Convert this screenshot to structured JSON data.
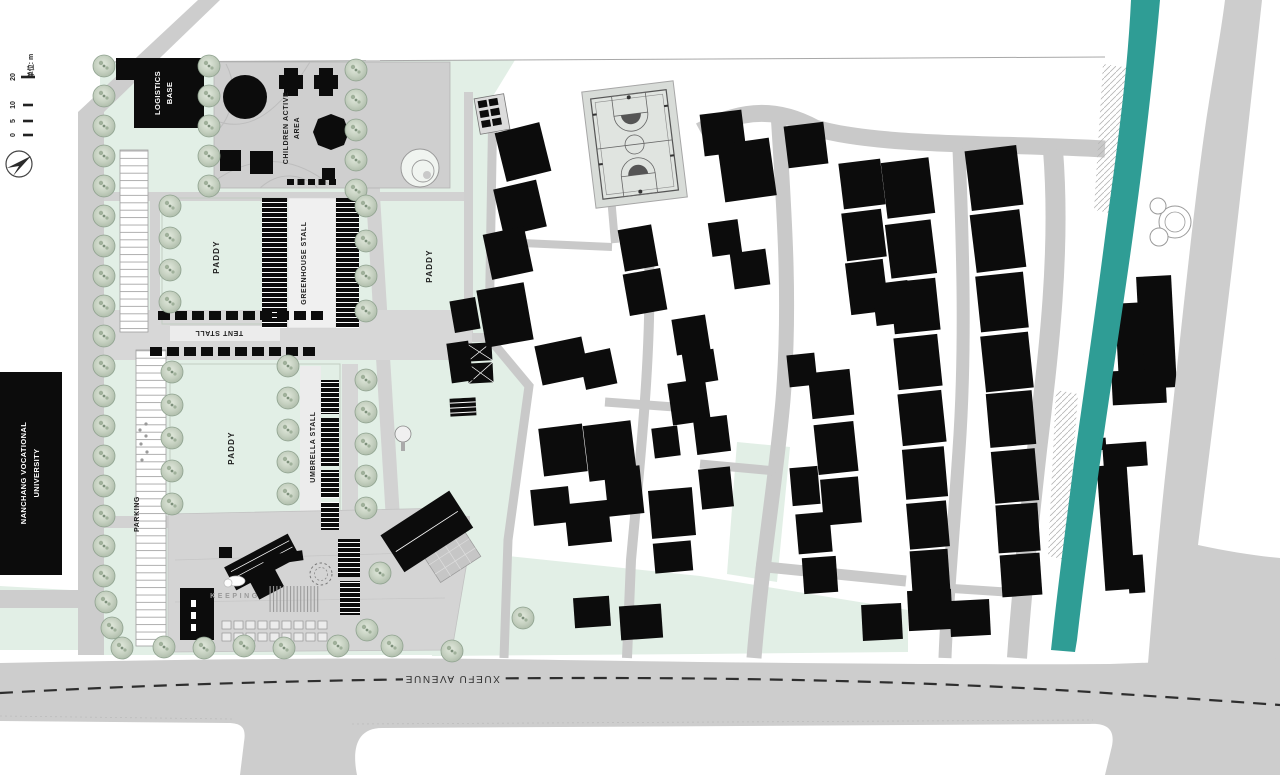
{
  "labels": {
    "logistics": {
      "l1": "LOGISTICS",
      "l2": "BASE"
    },
    "children": {
      "l1": "CHILDREN ACTIVE",
      "l2": "AREA"
    },
    "paddy1": "PADDY",
    "paddy2": "PADDY",
    "paddy3": "PADDY",
    "greenhouse": "GREENHOUSE STALL",
    "tent": "TENT STALL",
    "umbrella": "UMBRELLA STALL",
    "parking": "PARKING",
    "university": {
      "l1": "NANCHANG VOCATIONAL",
      "l2": "UNIVERSITY"
    },
    "keeping": "KEEPING",
    "avenue": "XUEFU AVENUE"
  },
  "scale_bar": {
    "ticks": [
      "0",
      "5",
      "10",
      "20"
    ],
    "unit": "单位: m"
  },
  "colors": {
    "mint": "#e2efe6",
    "road": "#cdcdcd",
    "road_dark": "#c9c9c9",
    "plaza": "#d2d2d2",
    "building": "#0c0c0c",
    "river": "#2f9d95",
    "tree_fill": "#c9d3c5",
    "tree_stroke": "#8fa28f",
    "court_bg": "#e0e4e0"
  },
  "plan": {
    "trees": [
      [
        104,
        66
      ],
      [
        104,
        96
      ],
      [
        104,
        126
      ],
      [
        104,
        156
      ],
      [
        104,
        186
      ],
      [
        104,
        216
      ],
      [
        104,
        246
      ],
      [
        104,
        276
      ],
      [
        104,
        306
      ],
      [
        104,
        336
      ],
      [
        104,
        366
      ],
      [
        104,
        396
      ],
      [
        104,
        426
      ],
      [
        104,
        456
      ],
      [
        104,
        486
      ],
      [
        104,
        516
      ],
      [
        104,
        546
      ],
      [
        104,
        576
      ],
      [
        106,
        602
      ],
      [
        112,
        628
      ],
      [
        209,
        66
      ],
      [
        209,
        96
      ],
      [
        209,
        126
      ],
      [
        209,
        156
      ],
      [
        209,
        186
      ],
      [
        356,
        70
      ],
      [
        356,
        100
      ],
      [
        356,
        130
      ],
      [
        356,
        160
      ],
      [
        356,
        190
      ],
      [
        170,
        206
      ],
      [
        170,
        238
      ],
      [
        170,
        270
      ],
      [
        170,
        302
      ],
      [
        366,
        206
      ],
      [
        366,
        241
      ],
      [
        366,
        276
      ],
      [
        366,
        311
      ],
      [
        172,
        372
      ],
      [
        172,
        405
      ],
      [
        172,
        438
      ],
      [
        172,
        471
      ],
      [
        172,
        504
      ],
      [
        288,
        366
      ],
      [
        288,
        398
      ],
      [
        288,
        430
      ],
      [
        288,
        462
      ],
      [
        288,
        494
      ],
      [
        366,
        380
      ],
      [
        366,
        412
      ],
      [
        366,
        444
      ],
      [
        366,
        476
      ],
      [
        366,
        508
      ],
      [
        122,
        648
      ],
      [
        164,
        647
      ],
      [
        204,
        648
      ],
      [
        244,
        646
      ],
      [
        284,
        648
      ],
      [
        338,
        646
      ],
      [
        392,
        646
      ],
      [
        452,
        651
      ],
      [
        380,
        573
      ],
      [
        367,
        630
      ],
      [
        523,
        618
      ]
    ],
    "village_buildings": [
      [
        500,
        127,
        46,
        50,
        -14
      ],
      [
        498,
        184,
        44,
        48,
        -13
      ],
      [
        487,
        230,
        42,
        46,
        -12
      ],
      [
        481,
        286,
        48,
        58,
        -10
      ],
      [
        452,
        299,
        26,
        32,
        -10
      ],
      [
        449,
        342,
        22,
        40,
        -8
      ],
      [
        538,
        341,
        48,
        40,
        -12
      ],
      [
        582,
        351,
        32,
        36,
        -12
      ],
      [
        541,
        426,
        44,
        48,
        -7
      ],
      [
        586,
        423,
        48,
        56,
        -7
      ],
      [
        532,
        488,
        38,
        36,
        -6
      ],
      [
        566,
        502,
        44,
        42,
        -6
      ],
      [
        606,
        467,
        36,
        48,
        -6
      ],
      [
        650,
        489,
        44,
        48,
        -5
      ],
      [
        654,
        542,
        38,
        30,
        -5
      ],
      [
        574,
        597,
        36,
        30,
        -4
      ],
      [
        620,
        605,
        42,
        34,
        -4
      ],
      [
        621,
        227,
        34,
        42,
        -10
      ],
      [
        626,
        271,
        38,
        42,
        -10
      ],
      [
        674,
        317,
        34,
        36,
        -9
      ],
      [
        684,
        351,
        32,
        32,
        -9
      ],
      [
        670,
        381,
        38,
        42,
        -8
      ],
      [
        695,
        417,
        34,
        36,
        -7
      ],
      [
        653,
        427,
        26,
        30,
        -7
      ],
      [
        702,
        112,
        42,
        42,
        -7
      ],
      [
        721,
        141,
        52,
        58,
        -8
      ],
      [
        710,
        221,
        30,
        34,
        -8
      ],
      [
        732,
        251,
        36,
        36,
        -8
      ],
      [
        700,
        468,
        32,
        40,
        -6
      ],
      [
        786,
        124,
        40,
        42,
        -7
      ],
      [
        841,
        161,
        42,
        46,
        -7
      ],
      [
        844,
        211,
        40,
        48,
        -7
      ],
      [
        848,
        261,
        38,
        52,
        -7
      ],
      [
        788,
        354,
        28,
        32,
        -6
      ],
      [
        810,
        371,
        42,
        46,
        -6
      ],
      [
        816,
        423,
        40,
        50,
        -6
      ],
      [
        822,
        478,
        38,
        46,
        -5
      ],
      [
        791,
        467,
        28,
        38,
        -5
      ],
      [
        797,
        513,
        34,
        40,
        -5
      ],
      [
        803,
        557,
        34,
        36,
        -4
      ],
      [
        874,
        282,
        36,
        42,
        -7
      ],
      [
        884,
        160,
        48,
        56,
        -7
      ],
      [
        888,
        222,
        46,
        54,
        -7
      ],
      [
        892,
        280,
        46,
        52,
        -6
      ],
      [
        896,
        336,
        44,
        52,
        -6
      ],
      [
        900,
        392,
        44,
        52,
        -6
      ],
      [
        904,
        448,
        42,
        50,
        -5
      ],
      [
        908,
        502,
        40,
        46,
        -5
      ],
      [
        911,
        550,
        38,
        42,
        -4
      ],
      [
        862,
        604,
        40,
        36,
        -3
      ],
      [
        908,
        590,
        44,
        40,
        -3
      ],
      [
        968,
        148,
        52,
        60,
        -7
      ],
      [
        973,
        212,
        50,
        58,
        -7
      ],
      [
        978,
        274,
        48,
        56,
        -6
      ],
      [
        983,
        334,
        48,
        56,
        -6
      ],
      [
        988,
        392,
        46,
        54,
        -5
      ],
      [
        993,
        450,
        44,
        52,
        -5
      ],
      [
        997,
        504,
        42,
        48,
        -4
      ],
      [
        1001,
        554,
        40,
        42,
        -4
      ],
      [
        950,
        600,
        40,
        36,
        -3
      ],
      [
        1139,
        276,
        35,
        112,
        -3
      ],
      [
        1117,
        303,
        26,
        84,
        -3
      ],
      [
        1112,
        370,
        54,
        34,
        -3
      ],
      [
        1103,
        443,
        44,
        24,
        -4
      ],
      [
        1101,
        465,
        30,
        125,
        -4
      ],
      [
        1128,
        555,
        16,
        38,
        -4
      ],
      [
        1096,
        438,
        10,
        12,
        -4
      ]
    ],
    "greenhouse_strips": [
      [
        262,
        198,
        25,
        130
      ],
      [
        336,
        198,
        23,
        130
      ]
    ],
    "umbrella_strips": [
      [
        321,
        380,
        18,
        34
      ],
      [
        321,
        418,
        18,
        48
      ],
      [
        321,
        470,
        18,
        28
      ],
      [
        321,
        502,
        18,
        28
      ]
    ],
    "tent_rows": [
      {
        "y": 311,
        "x0": 158,
        "count": 10,
        "step": 17,
        "w": 12,
        "h": 9
      },
      {
        "y": 347,
        "x0": 150,
        "count": 10,
        "step": 17,
        "w": 12,
        "h": 9
      }
    ],
    "top_dashes": {
      "y": 179,
      "x0": 287,
      "count": 5,
      "step": 10.5,
      "w": 7,
      "h": 6
    }
  }
}
